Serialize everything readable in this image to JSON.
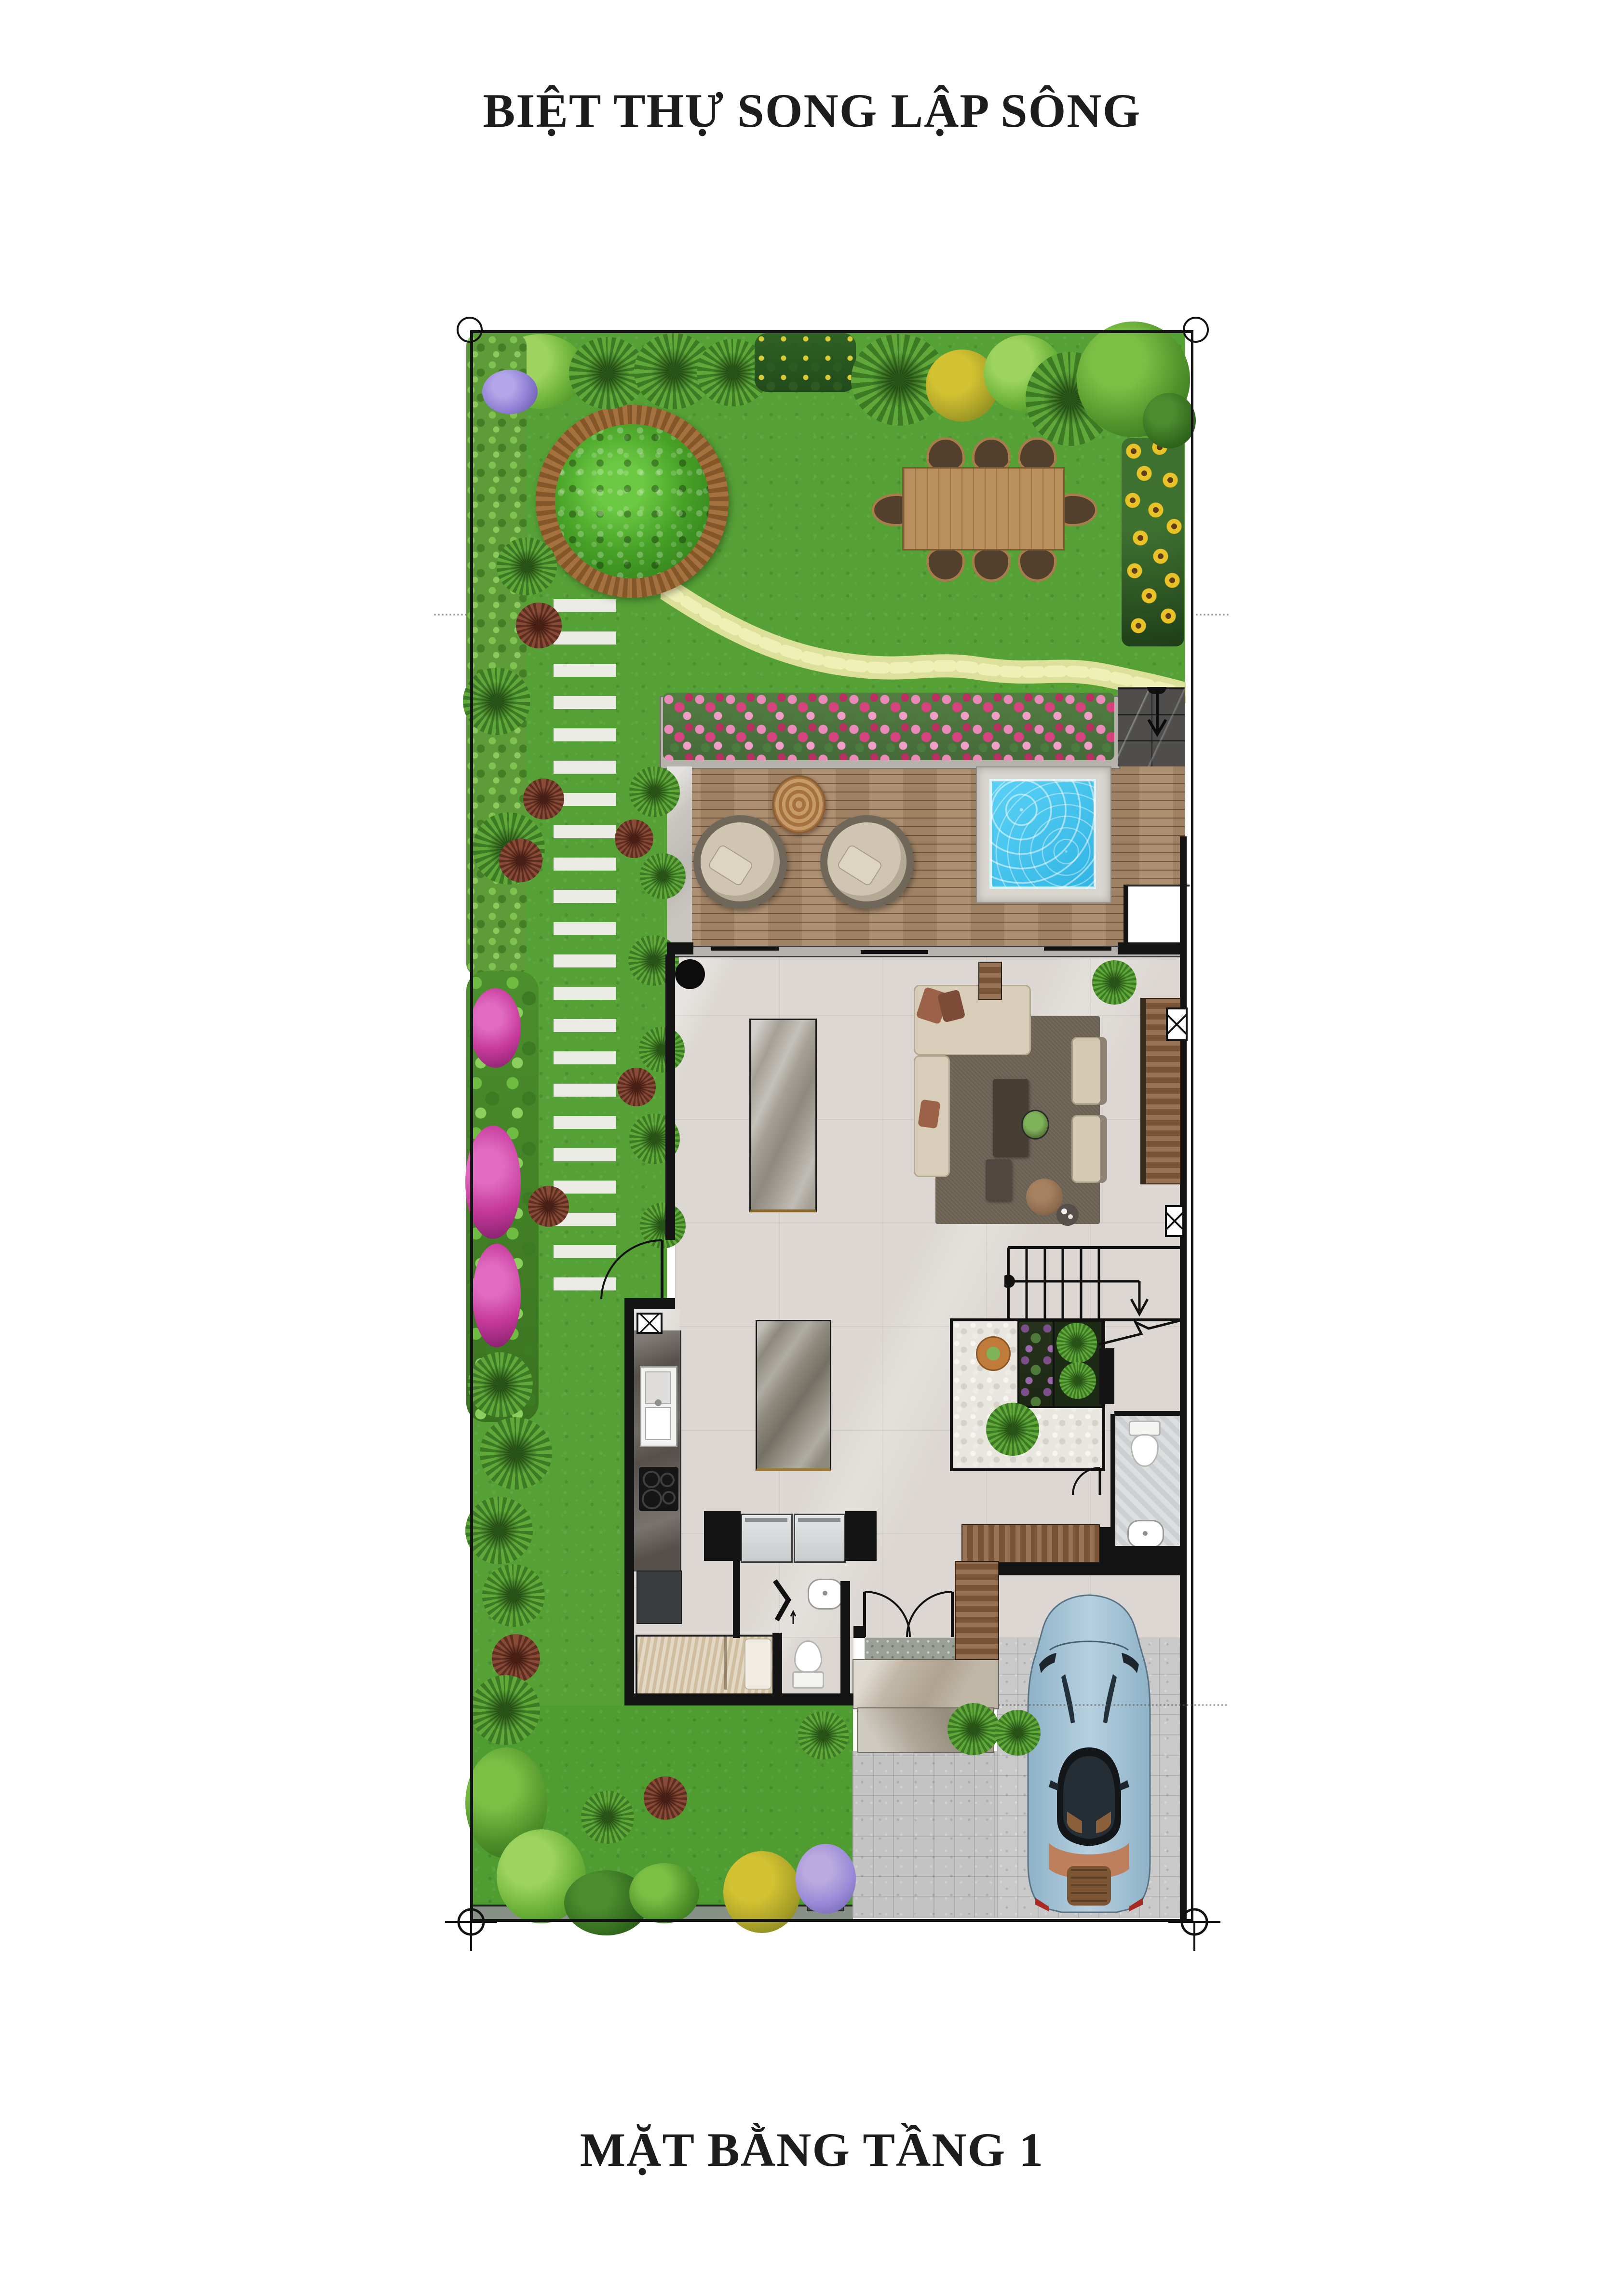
{
  "page": {
    "title": "BIỆT THỰ SONG LẬP SÔNG",
    "caption": "MẶT BẰNG TẦNG 1",
    "background": "#ffffff",
    "text_color": "#1d1d1d"
  },
  "plan": {
    "type": "villa-first-floor-plan",
    "areas": [
      "front-garden",
      "perimeter-hedge",
      "tree-bench-planter",
      "outdoor-dining-set",
      "sunflower-bed",
      "winding-stone-path",
      "stepping-stone-path",
      "flower-planter",
      "entry-walkway",
      "timber-deck",
      "lounge-chairs",
      "plunge-pool",
      "living-room",
      "sofa-set",
      "tv-console",
      "indoor-dining-table",
      "kitchen",
      "kitchen-island",
      "appliance-niche",
      "indoor-rock-garden",
      "staircase",
      "bathroom",
      "powder-room",
      "maid-room",
      "entry-foyer",
      "garage",
      "sports-car",
      "driveway",
      "rear-garden",
      "boundary-markers"
    ],
    "colors": {
      "grass": "#55a136",
      "deck_wood": "#a9896a",
      "pool_water": "#3fc3ef",
      "flower_pink": "#d6427e",
      "sunflower_yellow": "#e9c227",
      "interior_floor": "#dcd7d2",
      "wall_black": "#141414",
      "car_body": "#a7c3d6",
      "accent_wood": "#8a5f3e"
    }
  }
}
